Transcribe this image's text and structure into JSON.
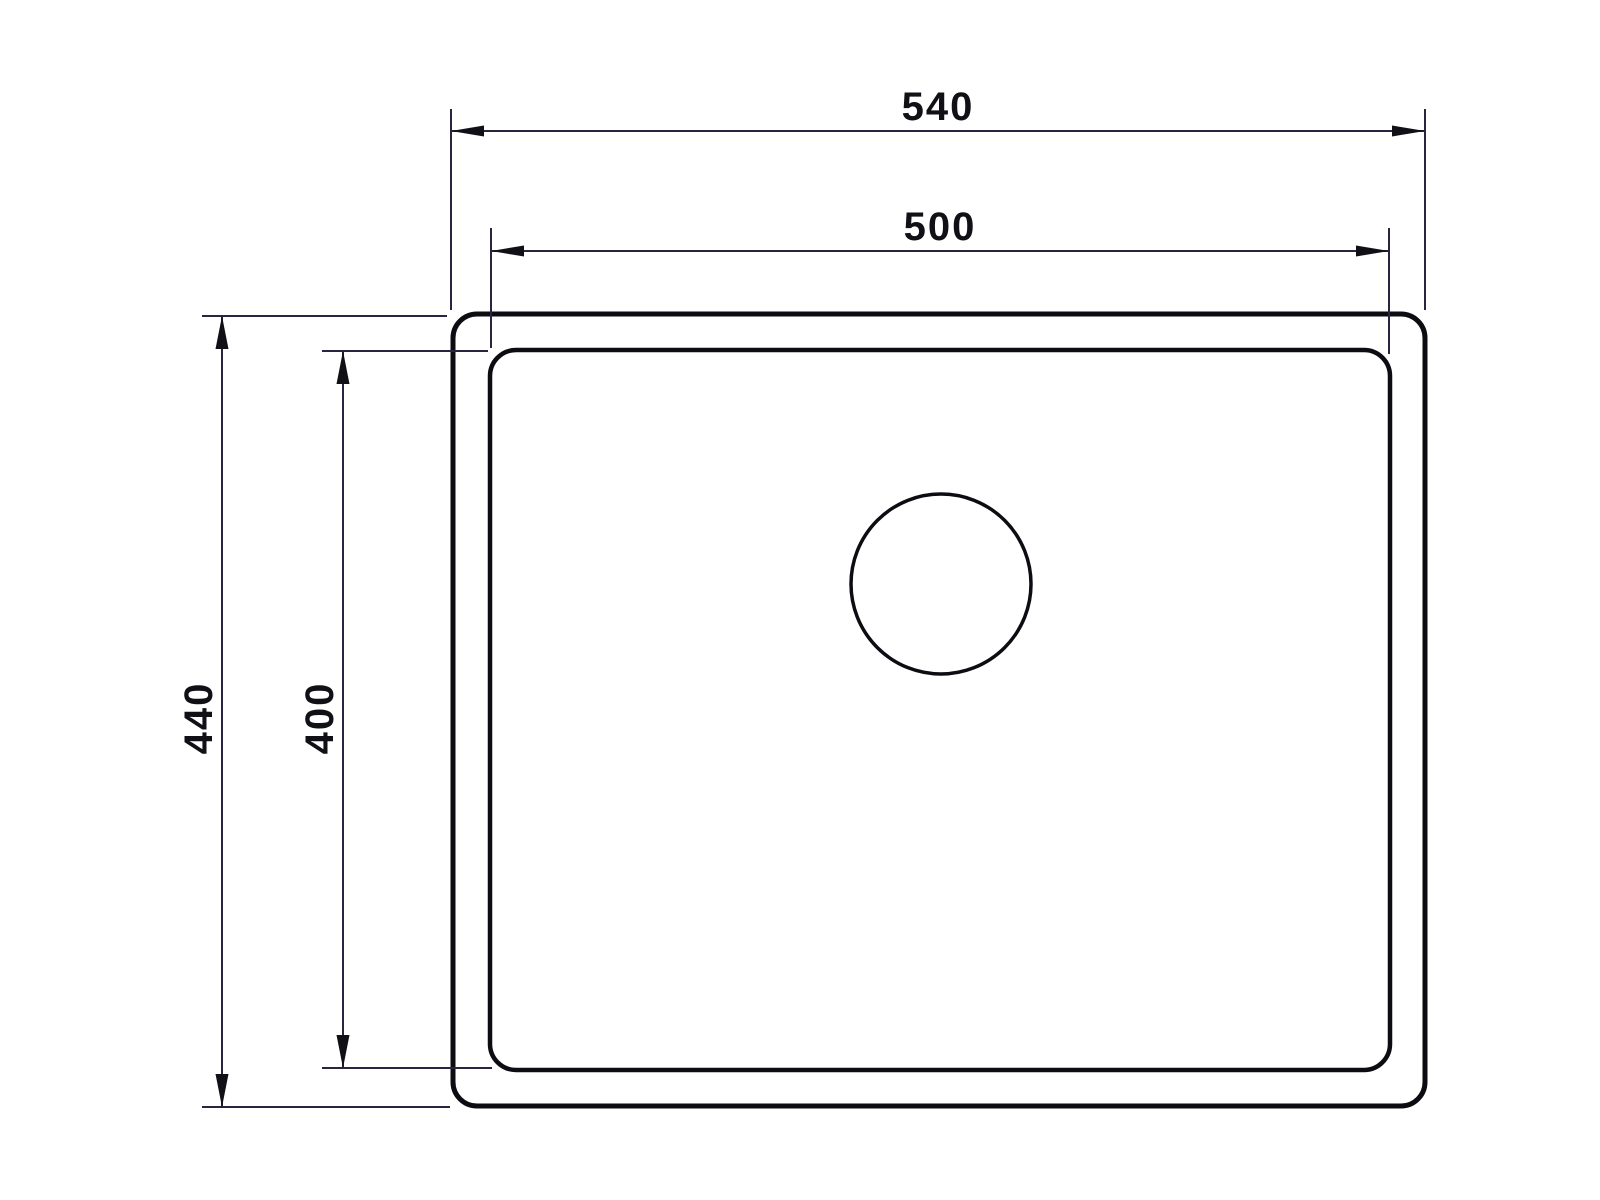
{
  "page": {
    "background_color": "#ffffff"
  },
  "drawing": {
    "type": "technical-dimension-drawing",
    "colors": {
      "outline": "#0c0c12",
      "dimension_line": "#262640",
      "annotation": "#101016",
      "background": "#ffffff"
    },
    "dimensions": {
      "outer_width": {
        "label": "540",
        "orientation": "horizontal"
      },
      "inner_width": {
        "label": "500",
        "orientation": "horizontal"
      },
      "outer_height": {
        "label": "440",
        "orientation": "vertical"
      },
      "inner_height": {
        "label": "400",
        "orientation": "vertical"
      }
    }
  }
}
